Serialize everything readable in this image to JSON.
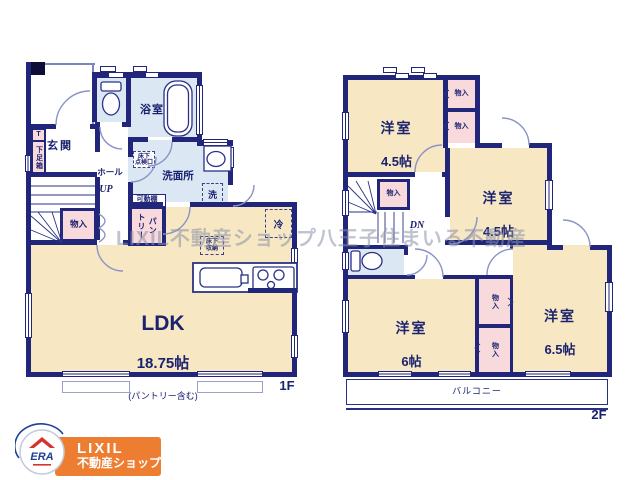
{
  "watermark": "LIXIL不動産ショップ八王子住まいる不動産",
  "logo": {
    "brand": "LIXIL",
    "sub": "不動産ショップ",
    "era": "ERA"
  },
  "floor1": {
    "label": "1F",
    "genkan": "玄関",
    "shoe_t": "T",
    "shoebox": "下足箱",
    "bath": "浴室",
    "washroom": "洗面所",
    "hall": "ホール",
    "up": "UP",
    "closet": "物入",
    "shelf": "可動棚",
    "pantry_col_right": "パン",
    "pantry_col_left": "トリー",
    "inspection": "床下\n点検口",
    "washer": "洗",
    "fridge": "冷",
    "floor_storage": "床下\n収納",
    "ldk": "LDK",
    "ldk_size": "18.75帖",
    "ldk_note": "(パントリー含む)"
  },
  "floor2": {
    "label": "2F",
    "western_room": "洋室",
    "size_a": "4.5帖",
    "size_b": "4.5帖",
    "size_c": "6帖",
    "size_d": "6.5帖",
    "closet": "物入",
    "dn": "DN",
    "balcony": "バルコニー"
  }
}
